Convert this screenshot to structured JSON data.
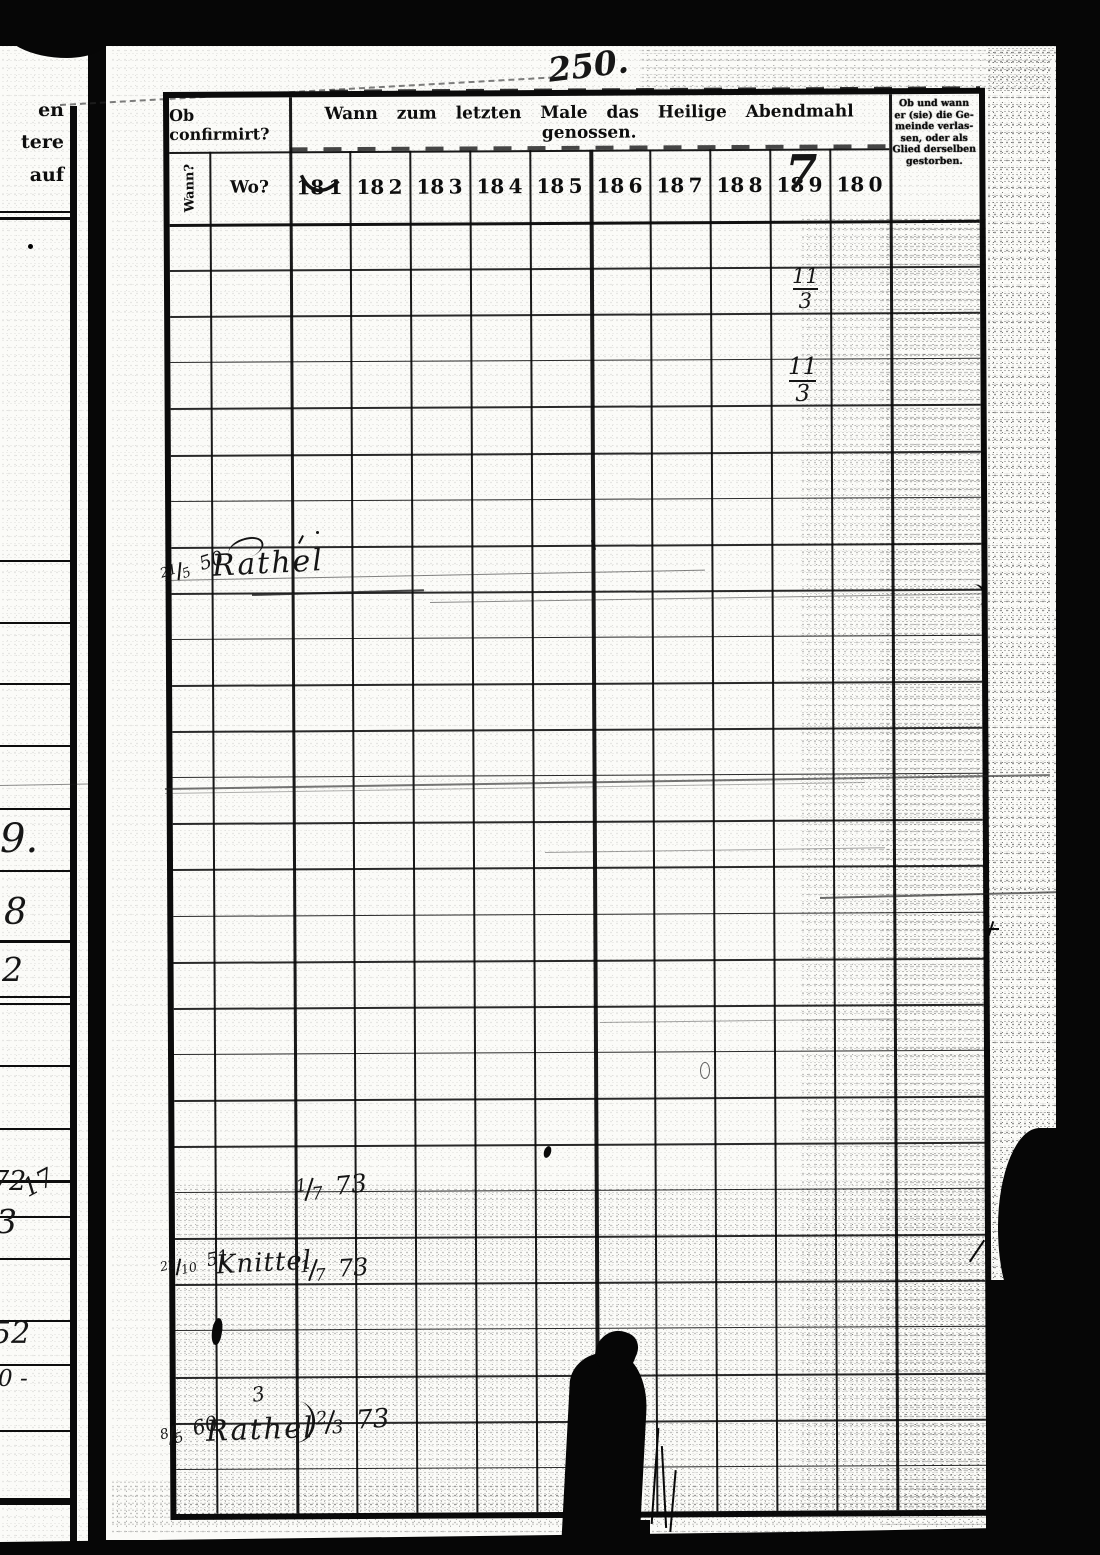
{
  "page_number": "250.",
  "left_page": {
    "printed_fragment": {
      "line1": "en",
      "line2": "tere",
      "line3": "auf"
    },
    "marginalia": {
      "m9": "9.",
      "m8": "8",
      "m2": "2",
      "m72": "72",
      "m17": "17",
      "m3": "3",
      "m52": "52",
      "m0": "0 -"
    }
  },
  "table": {
    "header": {
      "confirmed_label": "Ob confirmirt?",
      "communion_label": "Wann zum letzten Male das Heilige Abendmahl genossen.",
      "wann_label": "Wann?",
      "wo_label": "Wo?",
      "year_prefix": "18",
      "year_digits": [
        "1",
        "2",
        "3",
        "4",
        "5",
        "6",
        "7",
        "8",
        "9",
        "0"
      ],
      "year9_handwritten": "7",
      "departed_label_lines": {
        "l1": "Ob und wann",
        "l2": "er (sie) die Ge-",
        "l3": "meinde verlas-",
        "l4": "sen, oder als",
        "l5": "Glied derselben",
        "l6": "gestorben."
      }
    },
    "handwritten_entries": {
      "frac_a": {
        "num": "11",
        "den": "3"
      },
      "frac_b": {
        "num": "11",
        "den": "3"
      },
      "entry1": {
        "wann_num": "21",
        "wann_den": "5",
        "wann_year": "50",
        "wo": "Rathel"
      },
      "entry2": {
        "com_num": "1",
        "com_den": "7",
        "com_year": "73"
      },
      "entry3": {
        "wann_num": "22",
        "wann_den": "10",
        "wann_year": "51",
        "wo": "Knittel",
        "com_num": "1",
        "com_den": "7",
        "com_year": "73"
      },
      "entry4": {
        "wann_num": "8",
        "wann_den": "5",
        "wann_year": "60",
        "wo": "Rathel",
        "com_num": "2",
        "com_den": "3",
        "com_year": "73"
      },
      "stray_mark": "3"
    }
  }
}
